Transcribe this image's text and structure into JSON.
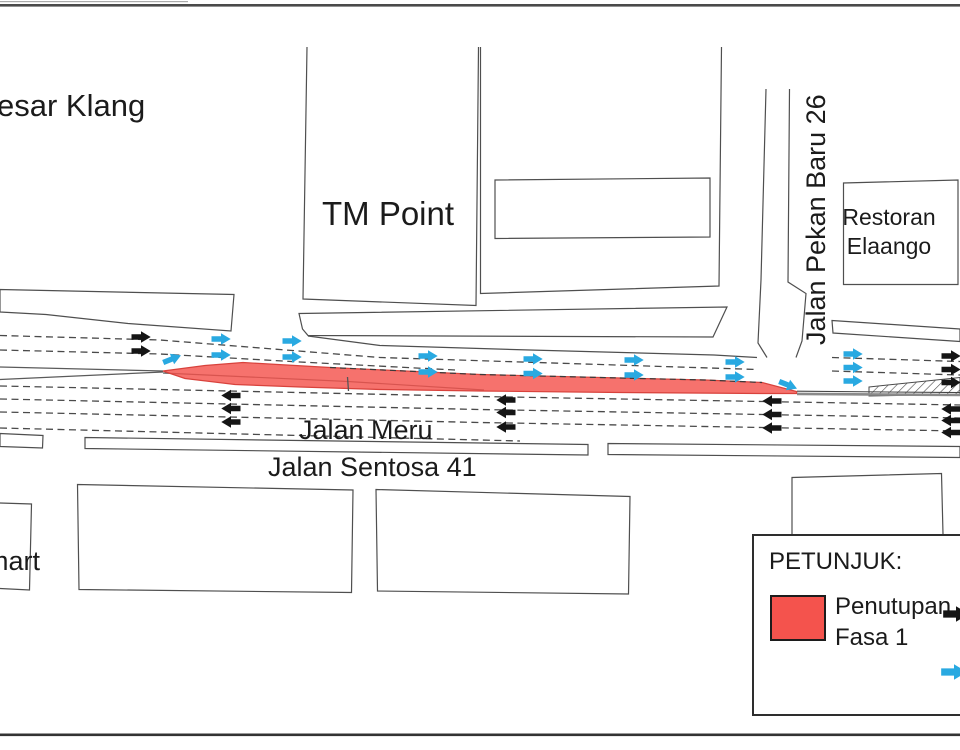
{
  "map": {
    "places": {
      "top_left_partial": "esar Klang",
      "tm_point": "TM Point",
      "restoran_line1": "Restoran",
      "restoran_line2": "Elaango",
      "mart_partial": "mart"
    },
    "roads": {
      "jalan_pekan_baru": "Jalan Pekan Baru 26",
      "jalan_meru": "Jalan Meru",
      "jalan_sentosa": "Jalan Sentosa 41"
    }
  },
  "legend": {
    "title": "PETUNJUK:",
    "closure_label_line1": "Penutupan",
    "closure_label_line2": "Fasa 1"
  },
  "colors": {
    "closure_red": "#f4534d",
    "closure_border": "#d8423c",
    "diversion_cyan": "#29a9e1",
    "traffic_black": "#151515"
  },
  "flow_arrows": {
    "groups": [
      {
        "name": "diversion-arrow",
        "color": "diversion_cyan",
        "arrows": [
          {
            "x": 172,
            "y": 359,
            "r": -22
          },
          {
            "x": 221,
            "y": 339
          },
          {
            "x": 221,
            "y": 355
          },
          {
            "x": 292,
            "y": 341
          },
          {
            "x": 292,
            "y": 357
          },
          {
            "x": 428,
            "y": 356
          },
          {
            "x": 428,
            "y": 372
          },
          {
            "x": 533,
            "y": 359
          },
          {
            "x": 533,
            "y": 373.5
          },
          {
            "x": 634,
            "y": 360
          },
          {
            "x": 634,
            "y": 375
          },
          {
            "x": 735,
            "y": 362
          },
          {
            "x": 735,
            "y": 377
          },
          {
            "x": 788,
            "y": 385,
            "r": 22
          },
          {
            "x": 853,
            "y": 354
          },
          {
            "x": 853,
            "y": 367.5
          },
          {
            "x": 853,
            "y": 381
          }
        ]
      },
      {
        "name": "traffic-arrow-right",
        "color": "traffic_black",
        "arrows": [
          {
            "x": 141,
            "y": 337
          },
          {
            "x": 141,
            "y": 351
          },
          {
            "x": 951,
            "y": 356
          },
          {
            "x": 951,
            "y": 369.5
          },
          {
            "x": 951,
            "y": 382.5
          }
        ]
      },
      {
        "name": "traffic-arrow-left",
        "color": "traffic_black",
        "arrows": [
          {
            "x": 231,
            "y": 395.5,
            "r": 180
          },
          {
            "x": 231,
            "y": 408.5,
            "r": 180
          },
          {
            "x": 231,
            "y": 422,
            "r": 180
          },
          {
            "x": 506,
            "y": 400,
            "r": 180
          },
          {
            "x": 506,
            "y": 412.5,
            "r": 180
          },
          {
            "x": 506,
            "y": 427,
            "r": 180
          },
          {
            "x": 772,
            "y": 401,
            "r": 180
          },
          {
            "x": 772,
            "y": 414.5,
            "r": 180
          },
          {
            "x": 772,
            "y": 428,
            "r": 180
          },
          {
            "x": 951,
            "y": 409,
            "r": 180
          },
          {
            "x": 951,
            "y": 420.5,
            "r": 180
          },
          {
            "x": 951,
            "y": 432.5,
            "r": 180
          }
        ]
      }
    ]
  }
}
